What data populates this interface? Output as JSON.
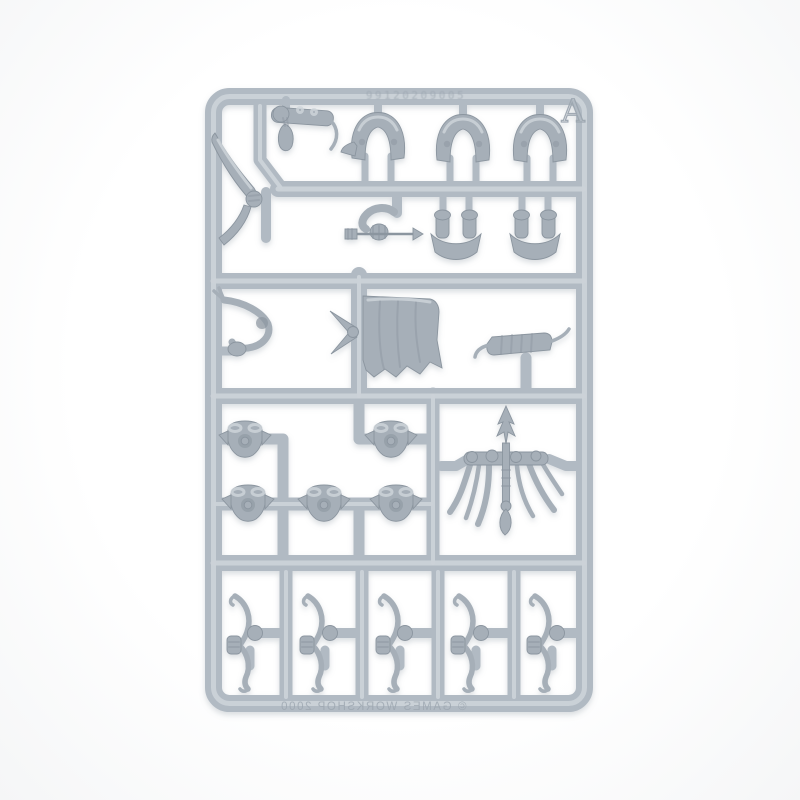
{
  "sprue": {
    "gate_letter": "A",
    "mold_number": "99120209005",
    "copyright_embossed": "© GAMES WORKSHOP 2000",
    "parts": [
      "curved-sword",
      "trophy-arm",
      "legs-pair-1",
      "legs-pair-2",
      "legs-pair-3",
      "arrow-arm",
      "lower-legs-1",
      "lower-legs-2",
      "horn-arm",
      "ragged-cloak",
      "quiver",
      "torso-1",
      "torso-2",
      "torso-3",
      "torso-4",
      "torso-5",
      "feathered-standard",
      "bow-1",
      "bow-2",
      "bow-3",
      "bow-4",
      "bow-5"
    ]
  },
  "colors": {
    "bg": "#ffffff",
    "runner": "#b1bac3",
    "runner-hi": "#cbd2d8",
    "runner-dk": "#9aa5af",
    "part": "#a6afb8",
    "part-dk": "#8b959f",
    "part-hi": "#d0d6db",
    "emboss": "#9ca6b0"
  }
}
